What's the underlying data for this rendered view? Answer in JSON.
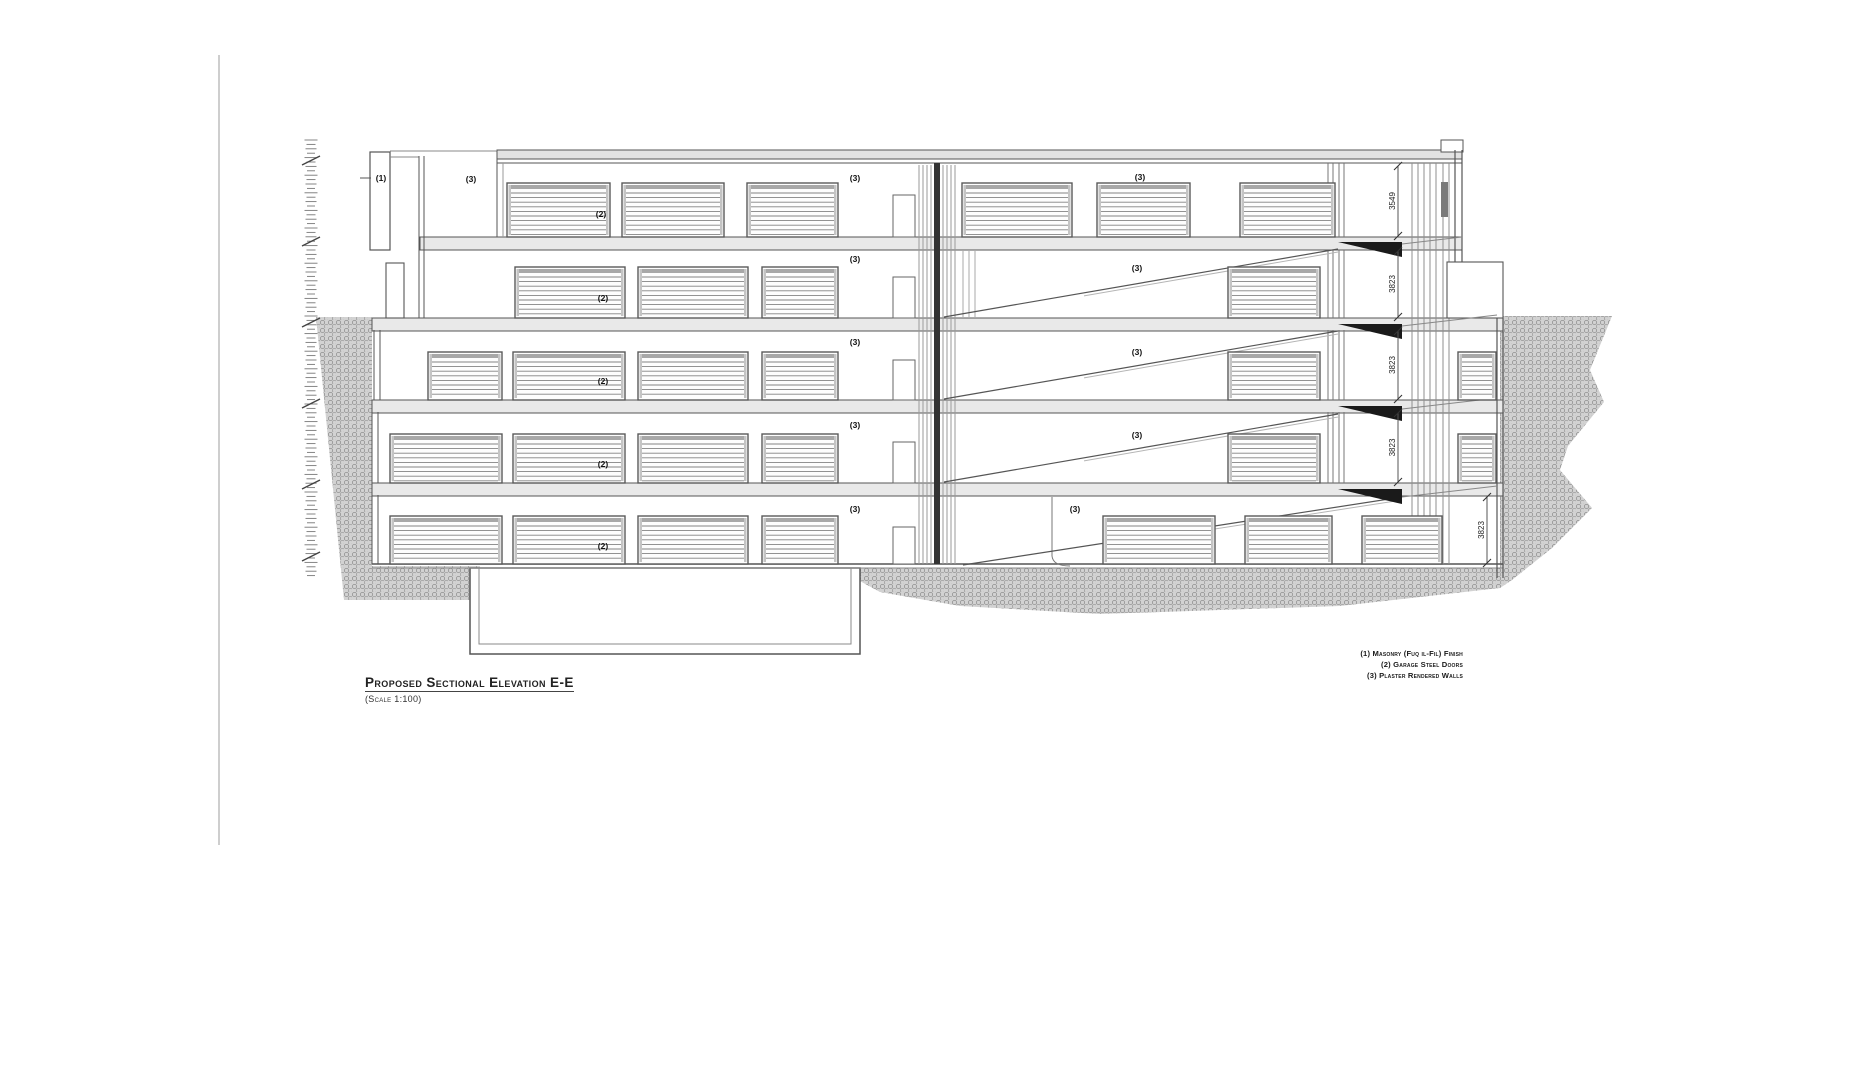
{
  "drawing": {
    "title": "Proposed Sectional Elevation E-E",
    "scale_note": "(Scale 1:100)",
    "legend_lines": [
      "(1) Masonry (Fuq il-Fil) Finish",
      "(2) Garage Steel Doors",
      "(3) Plaster Rendered Walls"
    ],
    "callouts": {
      "masonry": "(1)",
      "garage_steel_door": "(2)",
      "plaster_rendered_wall": "(3)"
    },
    "dimensions": {
      "floor_5": "3549",
      "floor_4": "3823",
      "floor_3": "3823",
      "floor_2": "3823",
      "floor_1": "3823"
    },
    "colors": {
      "line": "#555555",
      "dark_fill": "#1a1a1a",
      "hatch_base": "#d2d2d2",
      "hatch_ring": "#909090",
      "slab_fill": "#e9e9e9"
    }
  }
}
